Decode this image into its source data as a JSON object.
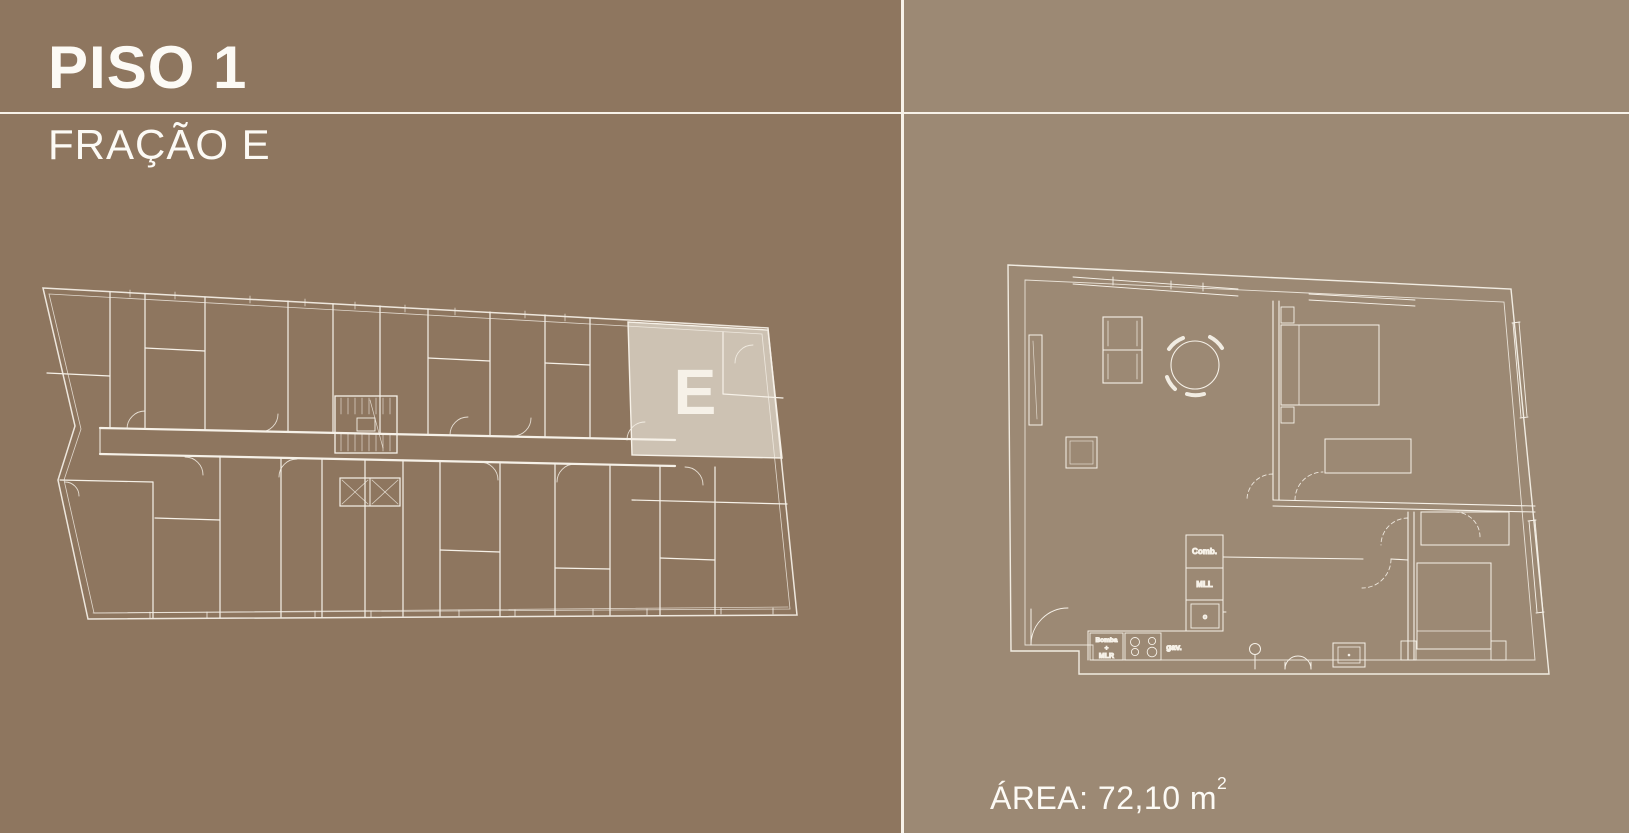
{
  "header": {
    "title": "PISO 1",
    "subtitle": "FRAÇÃO E"
  },
  "overview_plan": {
    "unit_letter": "E"
  },
  "detail_plan": {
    "area_label": "ÁREA: 72,10 m",
    "area_superscript": "2",
    "labels": {
      "comb": "Comb.",
      "mll": "MLL",
      "oven": "o",
      "bomba_line1": "Bomba",
      "bomba_line2": "+",
      "bomba_line3": "MLR",
      "gav": "gav."
    }
  },
  "colors": {
    "left_background": "#8E765F",
    "right_background": "#9C8974",
    "divider_line": "#F7F2E9",
    "plan_line": "#F6F1E8",
    "unit_highlight_fill": "#D2C8B9",
    "unit_letter": "#8F7961",
    "text": "#FCFAF5"
  }
}
